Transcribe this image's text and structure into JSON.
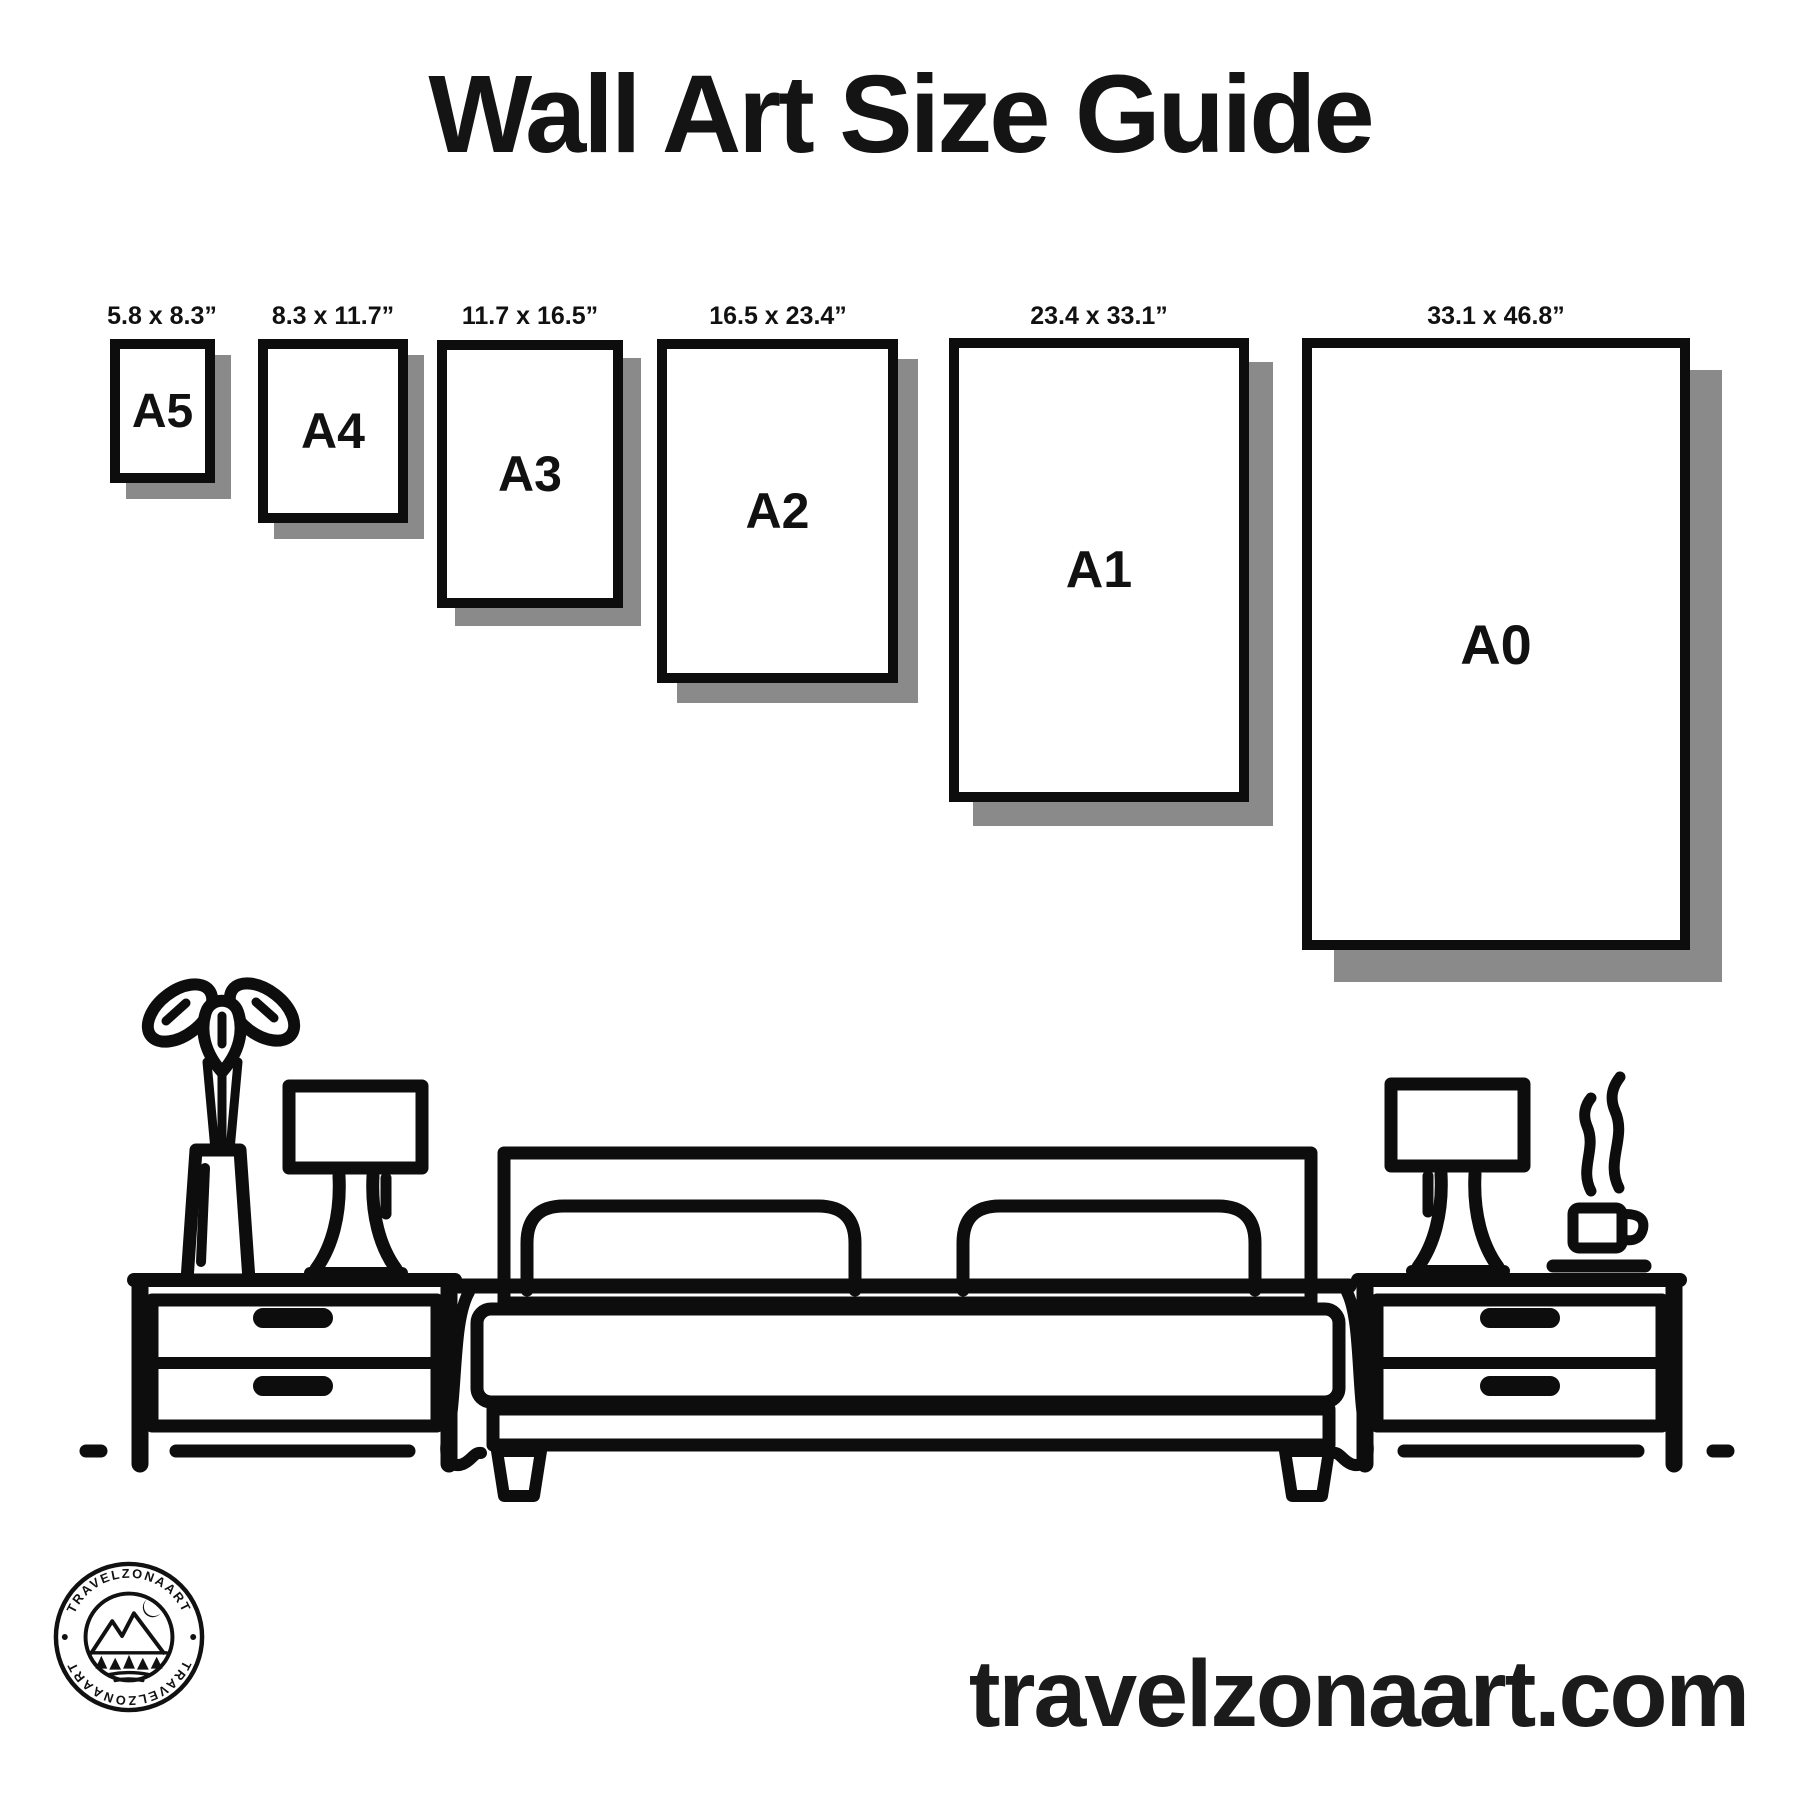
{
  "title": "Wall Art Size Guide",
  "size_guide": {
    "frames": [
      {
        "code": "A5",
        "dimensions": "5.8 x 8.3”"
      },
      {
        "code": "A4",
        "dimensions": "8.3 x 11.7”"
      },
      {
        "code": "A3",
        "dimensions": "11.7 x 16.5”"
      },
      {
        "code": "A2",
        "dimensions": "16.5 x 23.4”"
      },
      {
        "code": "A1",
        "dimensions": "23.4 x 33.1”"
      },
      {
        "code": "A0",
        "dimensions": "33.1 x 46.8”"
      }
    ]
  },
  "illustration": {
    "icons": [
      "plant-vase-icon",
      "table-lamp-left-icon",
      "nightstand-left-icon",
      "bed-icon",
      "table-lamp-right-icon",
      "coffee-cup-icon",
      "nightstand-right-icon"
    ]
  },
  "logo": {
    "text_top": "TRAVELZONAART",
    "text_bottom": "TRAVELZONAART"
  },
  "footer": {
    "website": "travelzonaart.com"
  },
  "colors": {
    "ink": "#0d0d0d",
    "frame_shadow": "#8a8a8a",
    "background": "#ffffff"
  }
}
